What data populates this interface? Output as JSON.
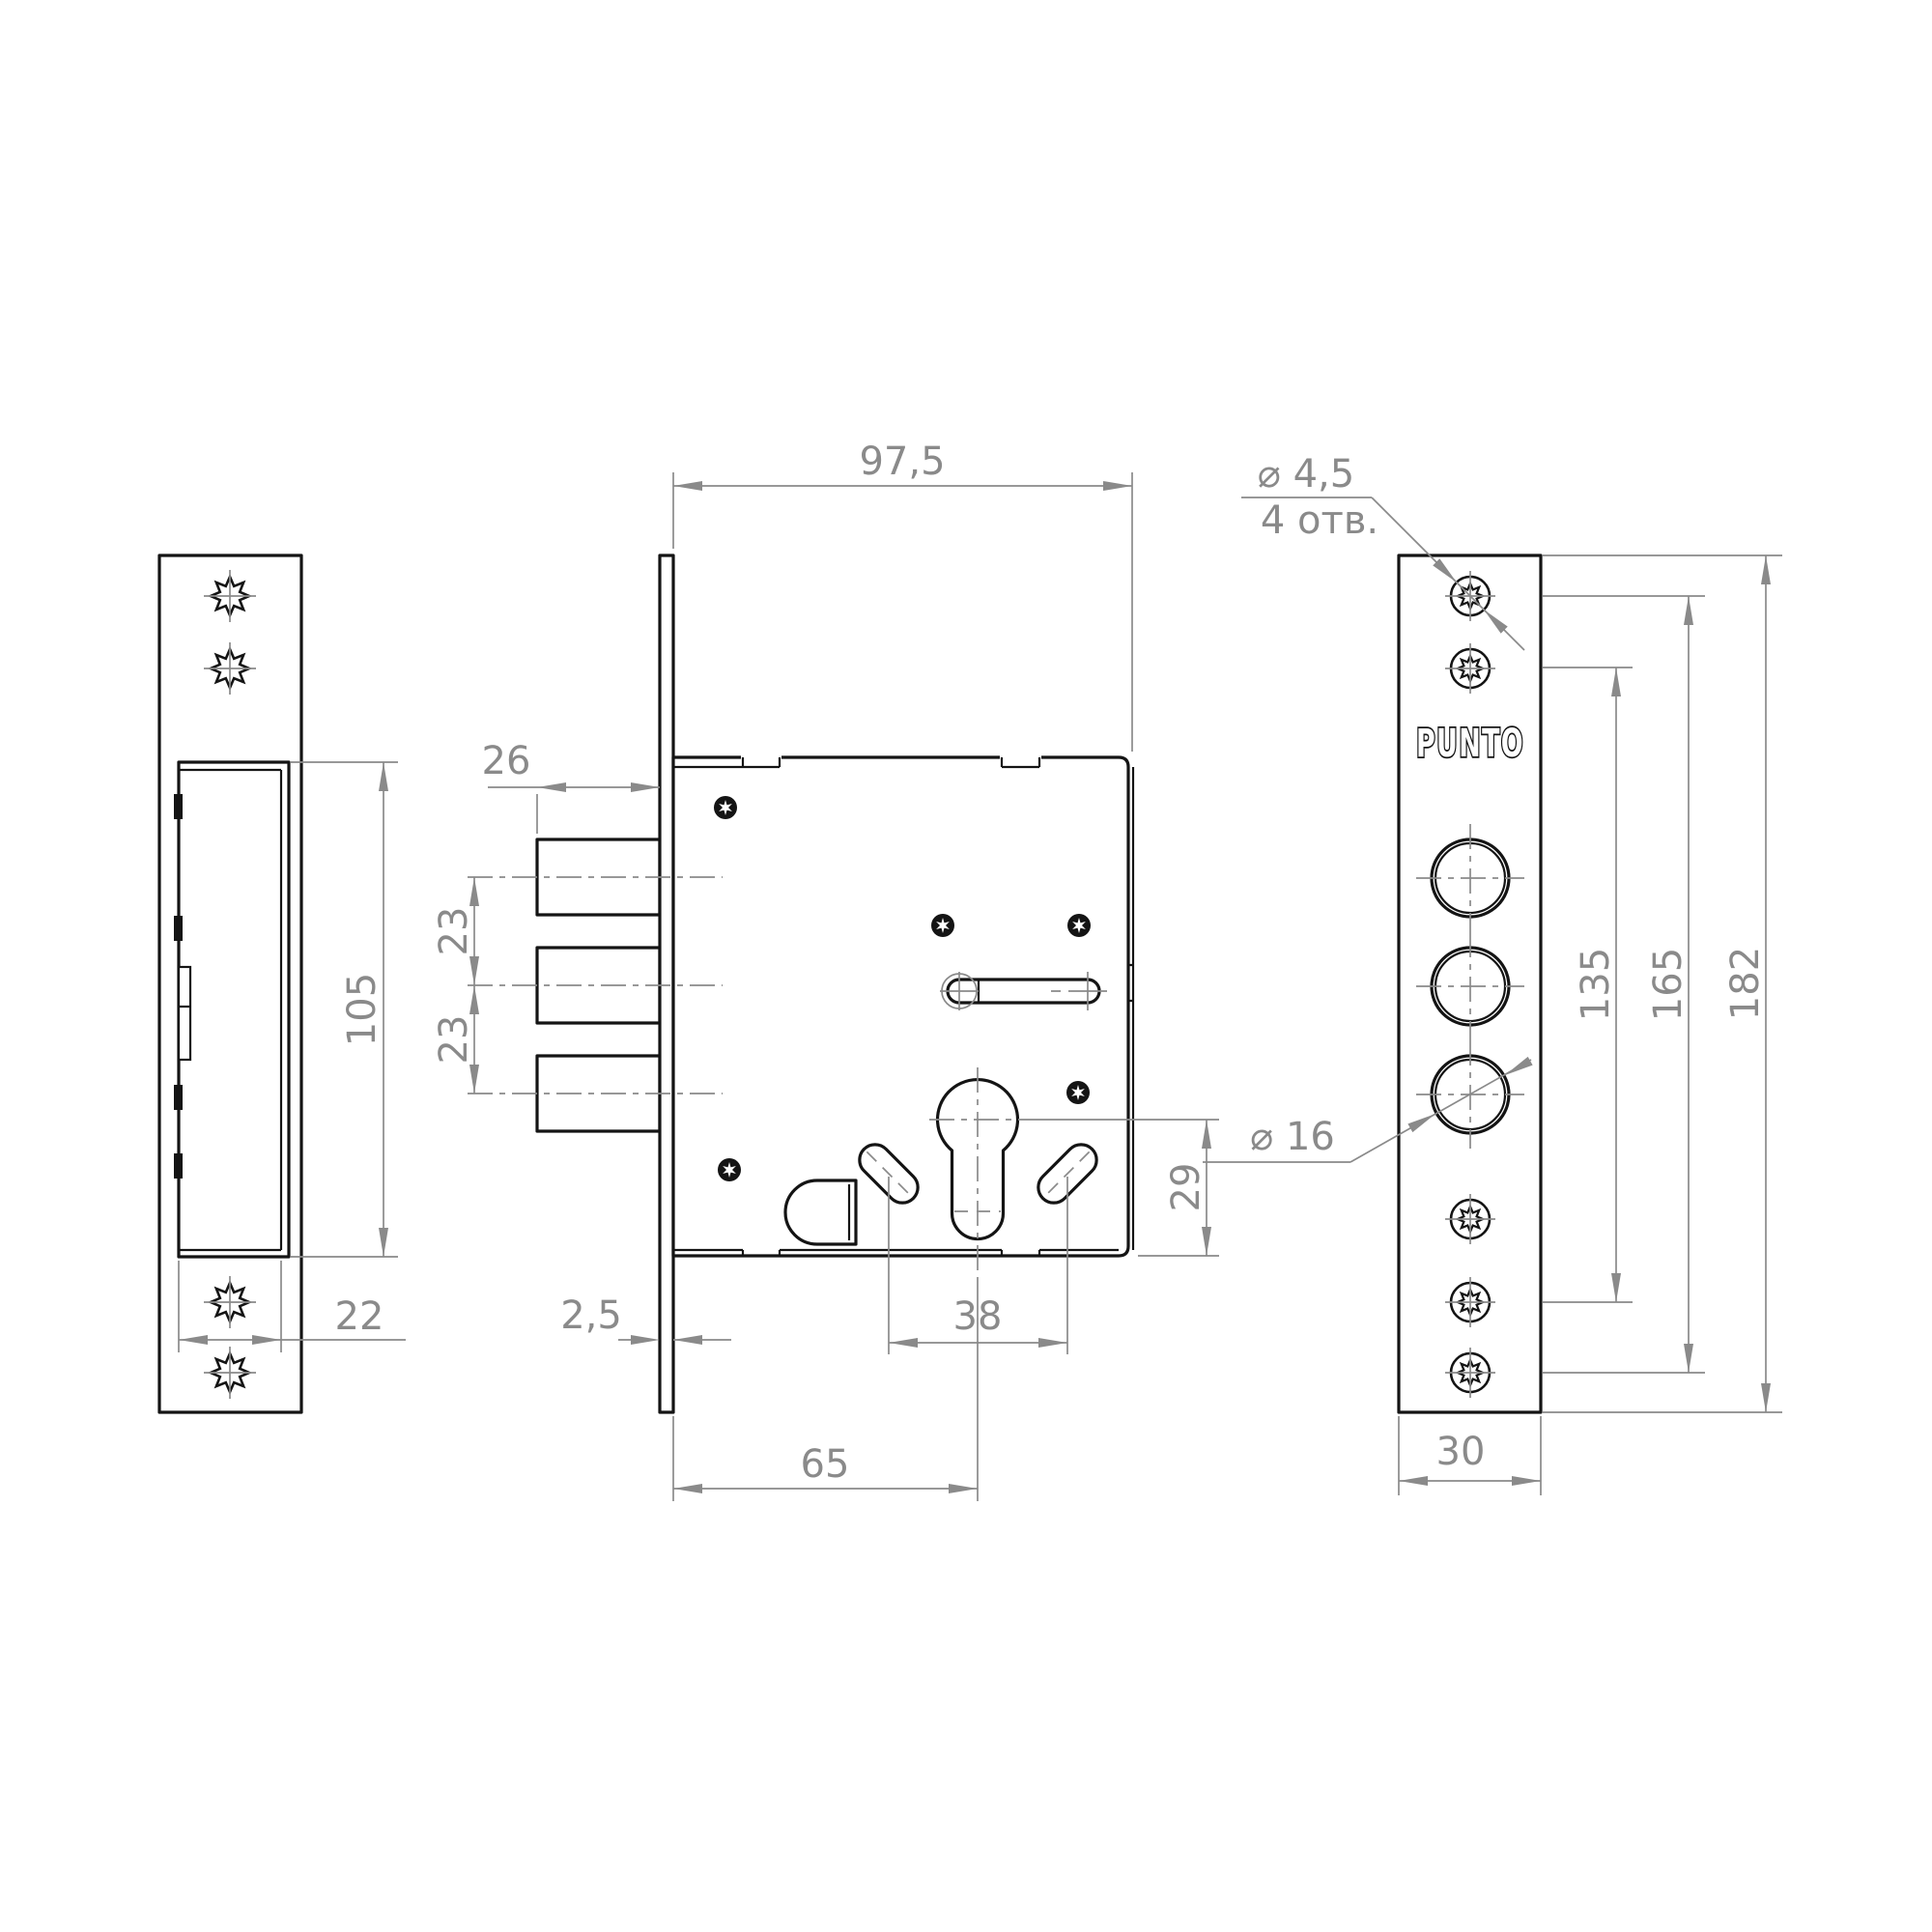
{
  "drawing": {
    "brand": "PUNTO",
    "dims": {
      "body_depth": "97,5",
      "bolt_throw": "26",
      "bolt_pitch_top": "23",
      "bolt_pitch_bottom": "23",
      "strike_cutout_height": "105",
      "strike_box_depth": "22",
      "faceplate_thickness": "2,5",
      "backset": "65",
      "handle_holes_span": "38",
      "cylinder_axis_to_bottom": "29",
      "mount_hole_dia": "⌀ 4,5",
      "mount_hole_count": "4 отв.",
      "bolt_hole_dia": "⌀ 16",
      "screws_span_inner": "135",
      "screws_span_outer": "165",
      "faceplate_height": "182",
      "faceplate_width": "30"
    }
  }
}
